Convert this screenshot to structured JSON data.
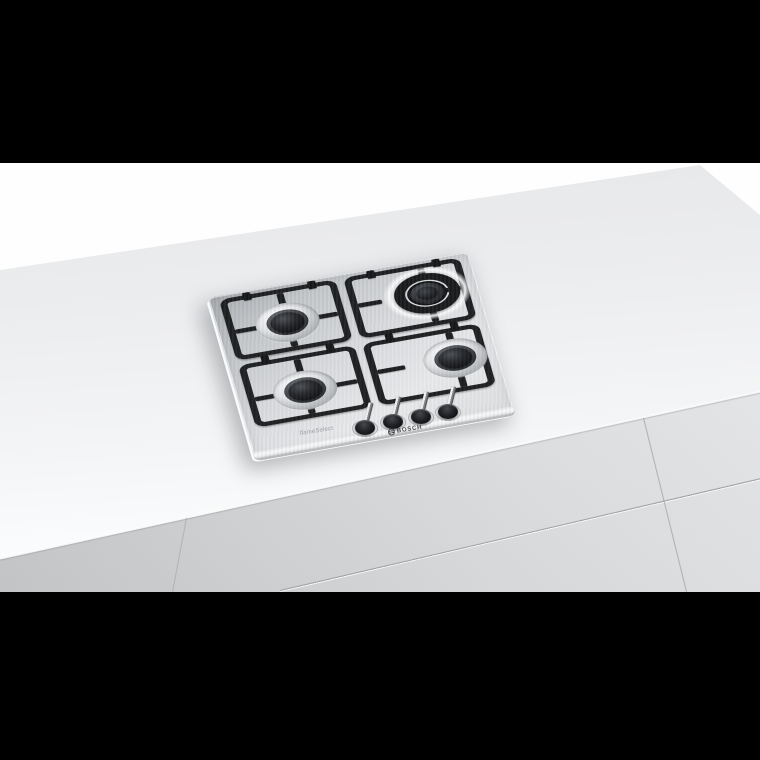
{
  "scene": {
    "subject": "stainless-steel 4-burner gas hob built into a white kitchen worktop, photographed at an angle with black letterbox bars above and below"
  },
  "hob": {
    "brand": "BOSCH",
    "marking": "flameSelect",
    "burners": [
      {
        "position": "back-left",
        "type": "standard"
      },
      {
        "position": "back-right",
        "type": "dual-ring-wok"
      },
      {
        "position": "front-left",
        "type": "standard"
      },
      {
        "position": "front-right",
        "type": "standard"
      }
    ],
    "knob_count": 4
  },
  "colors": {
    "letterbox": "#000000",
    "backdrop": "#fefefe",
    "countertop": "#ebecee",
    "cabinet_front": "#d6d7d9",
    "steel_surface": "#d8dadd",
    "grate": "#1b1d1f",
    "burner_cap": "#17181a"
  }
}
